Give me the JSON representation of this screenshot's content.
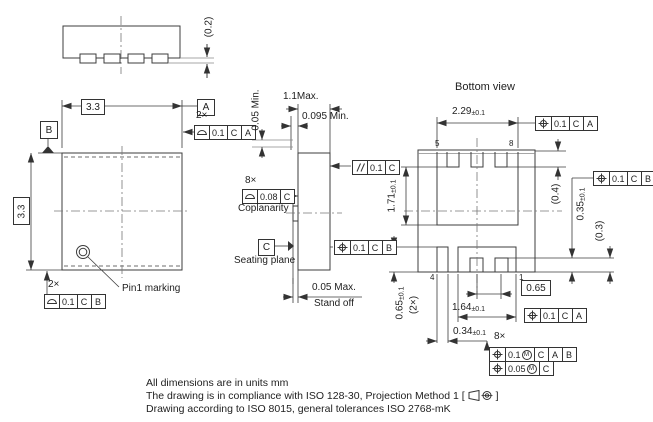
{
  "drawing": {
    "title_bottom_view": "Bottom view",
    "pin1_label": "Pin1 marking",
    "coplanarity_label": "Coplanarity",
    "seating_plane_label": "Seating plane",
    "stand_off_label": "Stand off",
    "datums": {
      "a": "A",
      "b": "B",
      "c": "C"
    },
    "counts": {
      "top_2x": "2×",
      "bottom_2x": "2×",
      "coplanarity_8x": "8×",
      "position_8x": "8×"
    },
    "pins": {
      "p1": "1",
      "p4": "4",
      "p5": "5",
      "p8": "8"
    },
    "dims": {
      "lead_thickness": "(0.2)",
      "body_w": "3.3",
      "body_h": "3.3",
      "height_min": "0.05 Min.",
      "height_max": "1.1Max.",
      "lead_len_min": "0.095 Min.",
      "standoff_max": "0.05 Max.",
      "pad_top_w": {
        "v": "2.29",
        "tol": "±0.1"
      },
      "top_terminal_len": "(0.4)",
      "bottom_terminal_len": {
        "v": "0.35",
        "tol": "±0.1"
      },
      "notch_depth": "(0.3)",
      "drain_pad_h": {
        "v": "1.71",
        "tol": "±0.1"
      },
      "gate_pad_h": {
        "v": "0.65",
        "tol": "±0.1"
      },
      "gate_pad_h_count": "(2×)",
      "pitch": "0.65",
      "source_pad_w": {
        "v": "1.64",
        "tol": "±0.1"
      },
      "gate_pad_w": {
        "v": "0.34",
        "tol": "±0.1"
      }
    },
    "fcf": {
      "profile_top": {
        "tol": "0.1",
        "d1": "C",
        "d2": "A"
      },
      "profile_bottom": {
        "tol": "0.1",
        "d1": "C",
        "d2": "B"
      },
      "coplanarity": {
        "tol": "0.08",
        "d1": "C"
      },
      "parallelism": {
        "tol": "0.1",
        "d1": "C"
      },
      "position_side": {
        "tol": "0.1",
        "d1": "C",
        "d2": "B"
      },
      "position_top": {
        "tol": "0.1",
        "d1": "C",
        "d2": "A"
      },
      "position_right": {
        "tol": "0.1",
        "d1": "C",
        "d2": "B"
      },
      "position_bottom": {
        "tol": "0.1",
        "d1": "C",
        "d2": "A"
      },
      "position_8x_a": {
        "tol": "0.1",
        "mod": "M",
        "d1": "C",
        "d2": "A",
        "d3": "B"
      },
      "position_8x_b": {
        "tol": "0.05",
        "mod": "M",
        "d1": "C"
      }
    },
    "notes": {
      "line1": "All dimensions are in units mm",
      "line2_prefix": "The drawing is in compliance with ISO 128-30, Projection Method 1 [",
      "line2_suffix": "]",
      "line3": "Drawing according to ISO 8015, general tolerances ISO 2768-mK"
    }
  }
}
